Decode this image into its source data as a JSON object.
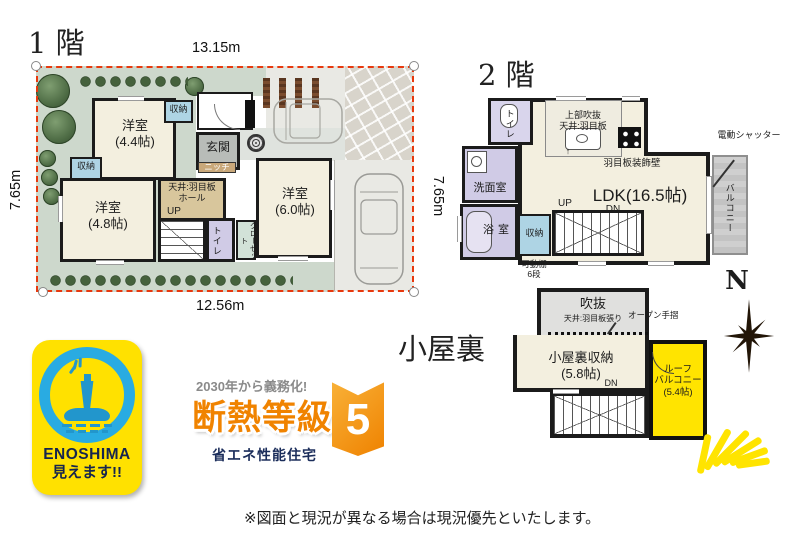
{
  "colors": {
    "boundary_red": "#e8380d",
    "roof_balcony_yellow": "#ffe400",
    "badge_blue": "#29abe2",
    "badge_navy": "#16254e",
    "insulation_orange": "#f08300",
    "wet_room_purple": "#d0cbe6",
    "storage_blue": "#aed4e4"
  },
  "floor1": {
    "title": "1 階",
    "dim_top": "13.15m",
    "dim_left": "7.65m",
    "dim_right": "7.65m",
    "dim_bottom": "12.56m",
    "rooms": {
      "bed44": "洋室\n(4.4帖)",
      "bed48": "洋室\n(4.8帖)",
      "bed60": "洋室\n(6.0帖)",
      "storage_a": "収納",
      "storage_b": "収納",
      "genkan": "玄関",
      "niche": "ニッチ",
      "hall": "天井:羽目板\nホール",
      "up": "UP",
      "toilet": "トイレ",
      "closet": "クローゼット"
    }
  },
  "floor2": {
    "title": "2 階",
    "rooms": {
      "toilet": "トイレ",
      "washroom": "洗面室",
      "bath": "浴室",
      "ldk": "LDK(16.5帖)",
      "void_label": "上部吹抜\n天井:羽目板",
      "deco_wall": "羽目板装飾壁",
      "arrow_up": "↑",
      "storage": "収納",
      "shelf": "可動棚\n6段",
      "up": "UP",
      "dn": "DN",
      "balcony": "バルコニー",
      "shutter": "電動シャッター"
    }
  },
  "attic": {
    "title": "小屋裏",
    "rooms": {
      "void": "吹抜",
      "void_sub": "天井:羽目板張り",
      "open_rail": "オープン手摺",
      "storage": "小屋裏収納\n(5.8帖)",
      "dn": "DN",
      "roof_balcony": "ルーフ\nバルコニー\n(5.4帖)"
    },
    "compass_n": "N"
  },
  "badges": {
    "enoshima": {
      "line1": "ENOSHIMA",
      "line2": "見えます!!"
    },
    "insulation": {
      "top": "2030年から義務化!",
      "main": "断熱等級",
      "number": "5",
      "sub": "省エネ性能住宅"
    }
  },
  "footer": {
    "note": "※図面と現況が異なる場合は現況優先といたします。"
  }
}
